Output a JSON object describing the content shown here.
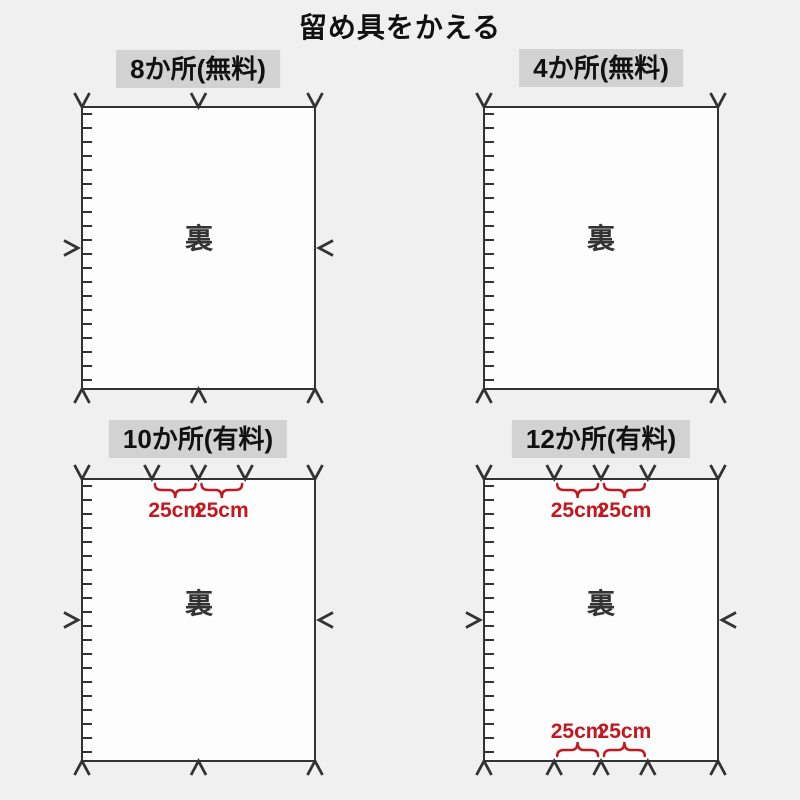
{
  "title": "留め具をかえる",
  "colors": {
    "background": "#f0f0f0",
    "panel_fill": "#fdfdfd",
    "line": "#333333",
    "label_background": "#d2d2d2",
    "label_text": "#111111",
    "accent_red": "#c2181f"
  },
  "panels": [
    {
      "id": "8-places",
      "label": "8か所(無料)",
      "back_label": "裏",
      "fasteners": {
        "top": [
          0,
          0.5,
          1
        ],
        "bottom": [
          0,
          0.5,
          1
        ],
        "left": true,
        "right": true
      },
      "annotations": {
        "top": [],
        "bottom": []
      }
    },
    {
      "id": "4-places",
      "label": "4か所(無料)",
      "back_label": "裏",
      "fasteners": {
        "top": [
          0,
          1
        ],
        "bottom": [
          0,
          1
        ],
        "left": false,
        "right": false
      },
      "annotations": {
        "top": [],
        "bottom": []
      }
    },
    {
      "id": "10-places",
      "label": "10か所(有料)",
      "back_label": "裏",
      "fasteners": {
        "top": [
          0,
          0.3,
          0.5,
          0.7,
          1
        ],
        "bottom": [
          0,
          0.5,
          1
        ],
        "left": true,
        "right": true
      },
      "annotations": {
        "top": [
          {
            "from": 0.3,
            "to": 0.5,
            "label": "25cm"
          },
          {
            "from": 0.5,
            "to": 0.7,
            "label": "25cm"
          }
        ],
        "bottom": []
      }
    },
    {
      "id": "12-places",
      "label": "12か所(有料)",
      "back_label": "裏",
      "fasteners": {
        "top": [
          0,
          0.3,
          0.5,
          0.7,
          1
        ],
        "bottom": [
          0,
          0.3,
          0.5,
          0.7,
          1
        ],
        "left": true,
        "right": true
      },
      "annotations": {
        "top": [
          {
            "from": 0.3,
            "to": 0.5,
            "label": "25cm"
          },
          {
            "from": 0.5,
            "to": 0.7,
            "label": "25cm"
          }
        ],
        "bottom": [
          {
            "from": 0.3,
            "to": 0.5,
            "label": "25cm"
          },
          {
            "from": 0.5,
            "to": 0.7,
            "label": "25cm"
          }
        ]
      }
    }
  ]
}
